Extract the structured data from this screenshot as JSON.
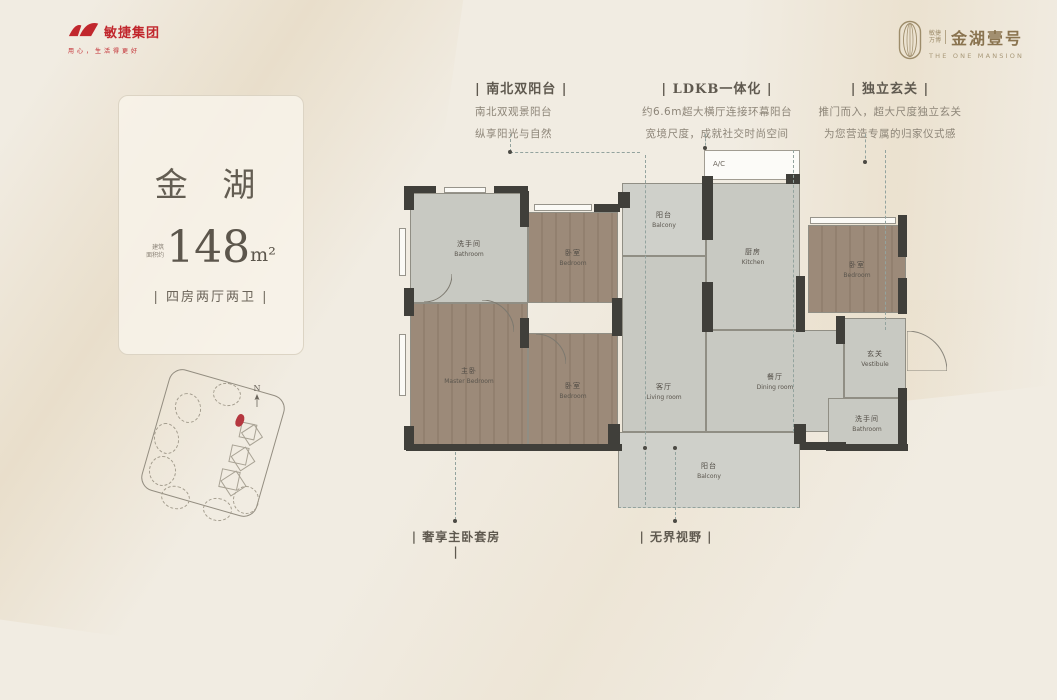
{
  "brand_left": {
    "name": "敏捷集团",
    "slogan": "用心，生活得更好"
  },
  "brand_right": {
    "tag_line1": "敏捷",
    "tag_line2": "万博",
    "name": "金湖壹号",
    "name_en": "THE ONE MANSION"
  },
  "callouts_top": [
    {
      "title": "| 南北双阳台 |",
      "line1": "南北双观景阳台",
      "line2": "纵享阳光与自然"
    },
    {
      "title": "| LDKB一体化 |",
      "line1": "约6.6m超大横厅连接环幕阳台",
      "line2": "宽境尺度，成就社交时尚空间"
    },
    {
      "title": "| 独立玄关 |",
      "line1": "推门而入，超大尺度独立玄关",
      "line2": "为您营造专属的归家仪式感"
    }
  ],
  "callouts_bottom": [
    {
      "title": "| 奢享主卧套房 |"
    },
    {
      "title": "| 无界视野 |"
    }
  ],
  "unit_card": {
    "name": "金 湖",
    "area_prefix_line1": "建筑",
    "area_prefix_line2": "面积约",
    "area_value": "148",
    "area_unit": "m²",
    "layout": "| 四房两厅两卫 |"
  },
  "floor_plan": {
    "ac_label": "A/C",
    "rooms": [
      {
        "cn": "洗手间",
        "en": "Bathroom"
      },
      {
        "cn": "卧室",
        "en": "Bedroom"
      },
      {
        "cn": "阳台",
        "en": "Balcony"
      },
      {
        "cn": "厨房",
        "en": "Kitchen"
      },
      {
        "cn": "卧室",
        "en": "Bedroom"
      },
      {
        "cn": "主卧",
        "en": "Master Bedroom"
      },
      {
        "cn": "卧室",
        "en": "Bedroom"
      },
      {
        "cn": "客厅",
        "en": "Living room"
      },
      {
        "cn": "餐厅",
        "en": "Dining room"
      },
      {
        "cn": "玄关",
        "en": "Vestibule"
      },
      {
        "cn": "洗手间",
        "en": "Bathroom"
      },
      {
        "cn": "阳台",
        "en": "Balcony"
      }
    ]
  },
  "site_plan": {
    "north_label": "N"
  },
  "colors": {
    "brand_red": "#c1272d",
    "brand_gold": "#8a7450",
    "highlight_red": "#b5373f",
    "wall": "#403f3a",
    "room_gray": "#c8c9c2",
    "room_wood": "#9c8a79",
    "background": "#f1ece2"
  }
}
